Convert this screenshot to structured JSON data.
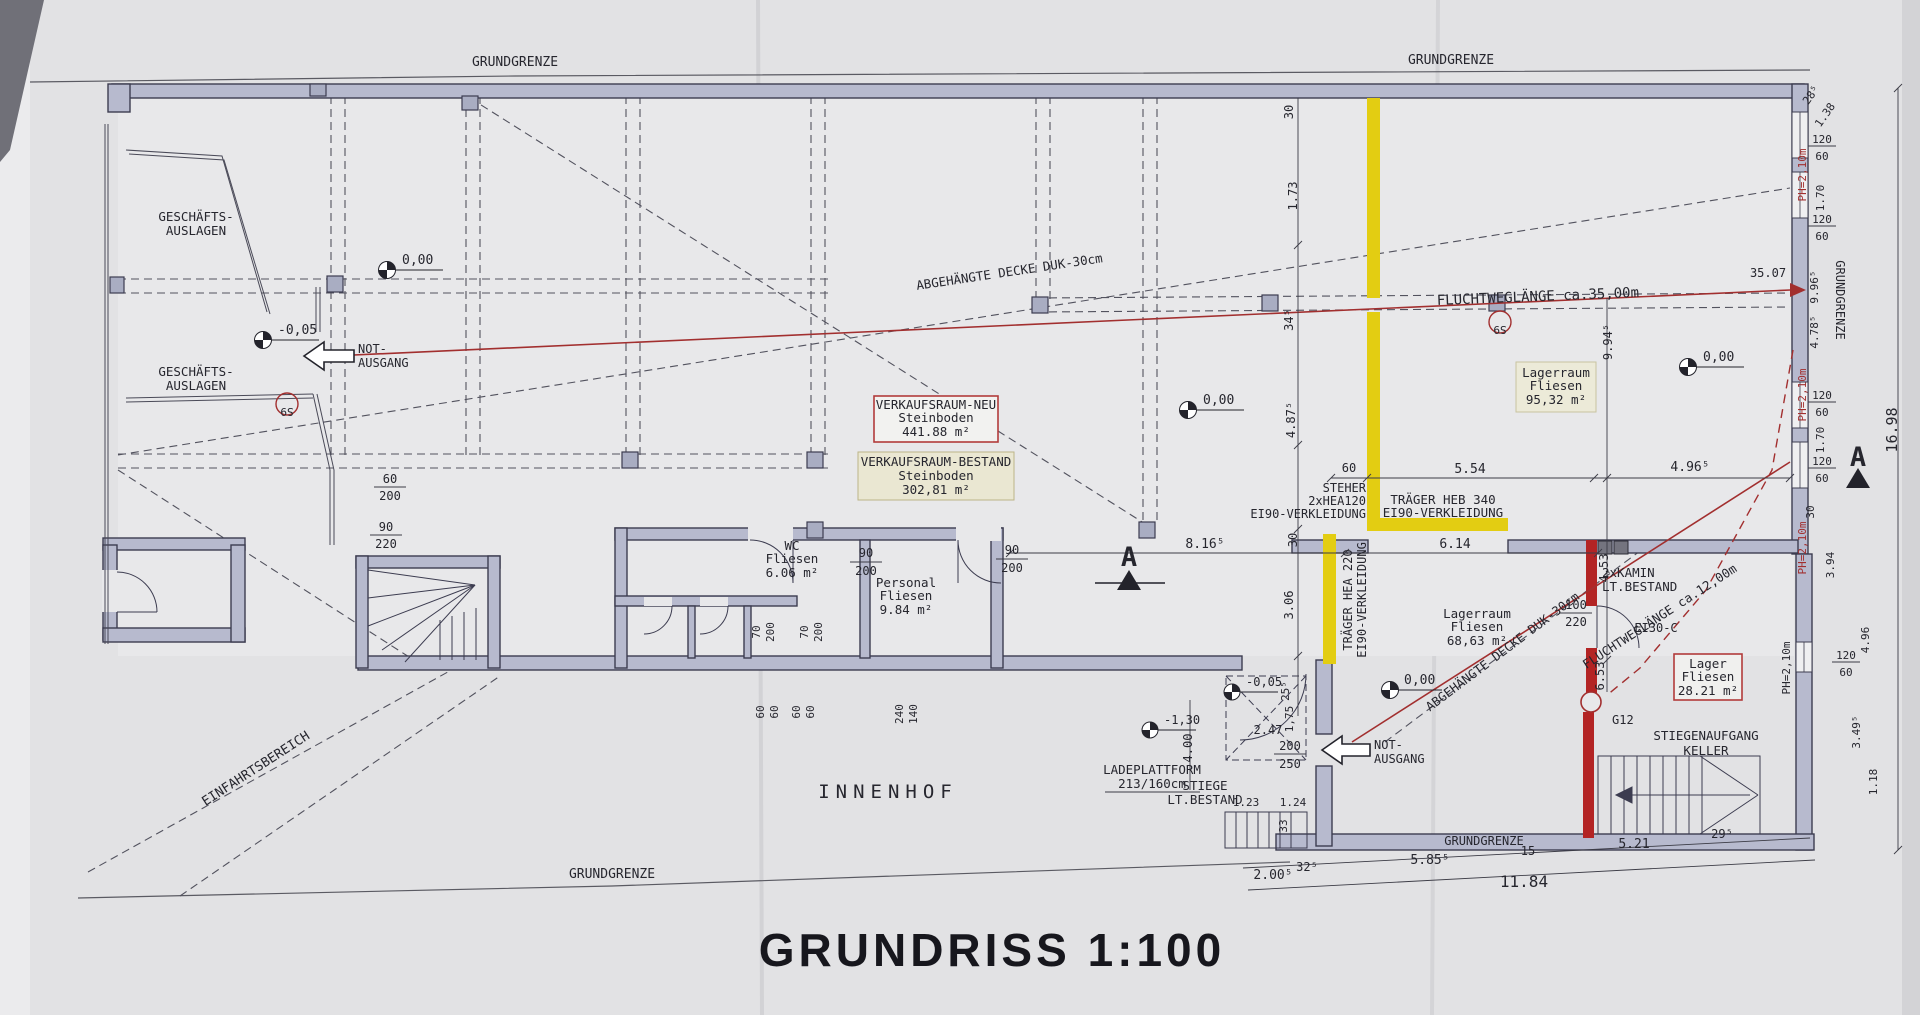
{
  "title": "GRUNDRISS 1:100",
  "labels": {
    "grundgrenze": "GRUNDGRENZE",
    "einfahrtsbereich": "EINFAHRTSBEREICH",
    "innenhof": "INNENHOF",
    "geschaefts1": "GESCHÄFTS-",
    "geschaefts2": "AUSLAGEN",
    "not1": "NOT-",
    "not2": "AUSGANG",
    "s9": "S9",
    "g12": "G12",
    "ei30c": "EI30-C",
    "kamin1": "2xKAMIN",
    "kamin2": "LT.BESTAND",
    "decke": "ABGEHÄNGTE DECKE DUK-30cm",
    "flucht35": "FLUCHTWEGLÄNGE ca.35,00m",
    "flucht35_val": "35.07",
    "flucht12": "FLUCHTWEGLÄNGE ca.12,00m",
    "ph": "PH=2,10m",
    "ladeplattform1": "LADEPLATTFORM",
    "ladeplattform2": "213/160cm",
    "stiege1": "STIEGE",
    "stiege2": "LT.BESTAND",
    "stiegenaufgang1": "STIEGENAUFGANG",
    "stiegenaufgang2": "KELLER"
  },
  "rooms": {
    "verkaufsraum_neu": {
      "name": "VERKAUFSRAUM-NEU",
      "floor": "Steinboden",
      "area": "441.88 m²"
    },
    "verkaufsraum_bestand": {
      "name": "VERKAUFSRAUM-BESTAND",
      "floor": "Steinboden",
      "area": "302,81 m²"
    },
    "lagerraum_nord": {
      "name": "Lagerraum",
      "floor": "Fliesen",
      "area": "95,32 m²"
    },
    "lagerraum_sued": {
      "name": "Lagerraum",
      "floor": "Fliesen",
      "area": "68,63 m²"
    },
    "lager": {
      "name": "Lager",
      "floor": "Fliesen",
      "area": "28.21 m²"
    },
    "wc": {
      "name": "WC",
      "floor": "Fliesen",
      "area": "6.06 m²"
    },
    "personal": {
      "name": "Personal",
      "floor": "Fliesen",
      "area": "9.84 m²"
    }
  },
  "beams": {
    "steher1": "STEHER",
    "steher2": "2xHEA120",
    "steher3": "EI90-VERKLEIDUNG",
    "heb1": "TRÄGER HEB 340",
    "heb2": "EI90-VERKLEIDUNG",
    "hea1": "TRÄGER HEA 220",
    "hea2": "EI90-VERKLEIDUNG"
  },
  "elevations": {
    "e000": "0,00",
    "e005": "-0,05",
    "e130": "-1,30"
  },
  "windows": {
    "w": "120",
    "h": "60"
  },
  "doors": {
    "d90": "90",
    "d200": "200",
    "d70": "70",
    "d60": "60",
    "d240": "240",
    "d140": "140",
    "d220": "220",
    "d250": "250",
    "d100": "100"
  },
  "dims": {
    "d816": "8.16⁵",
    "d614": "6.14",
    "d554": "5.54",
    "d496": "4.96⁵",
    "d60": "60",
    "d30": "30",
    "d173": "1.73",
    "d345": "34⁵",
    "d487": "4.87⁵",
    "d306": "3.06",
    "d255": "25⁵",
    "d175": "1,75",
    "d994": "9.94⁵",
    "d453": "4,53",
    "d653": "6.53",
    "d247": "2.47",
    "d400": "4.00",
    "d124": "1.24",
    "d123": "1.23",
    "d33": "33",
    "d2005": "2.00⁵",
    "d325": "32⁵",
    "d5855": "5.85⁵",
    "d15": "15",
    "d521": "5.21",
    "d295": "29⁵",
    "d1184": "11.84",
    "d1698": "16.98",
    "d996": "9.96⁵",
    "d478": "4.78⁵",
    "d138": "1.38",
    "d285": "28⁵",
    "d394": "3.94",
    "d496b": "4.96",
    "d3495": "3.49⁵",
    "d118": "1.18",
    "d170": "1.70"
  },
  "section": {
    "a": "A"
  },
  "colors": {
    "wall": "#b7bace",
    "yellow": "#e3cd12",
    "red": "#a22f2f",
    "paper": "#e2e2e4"
  }
}
